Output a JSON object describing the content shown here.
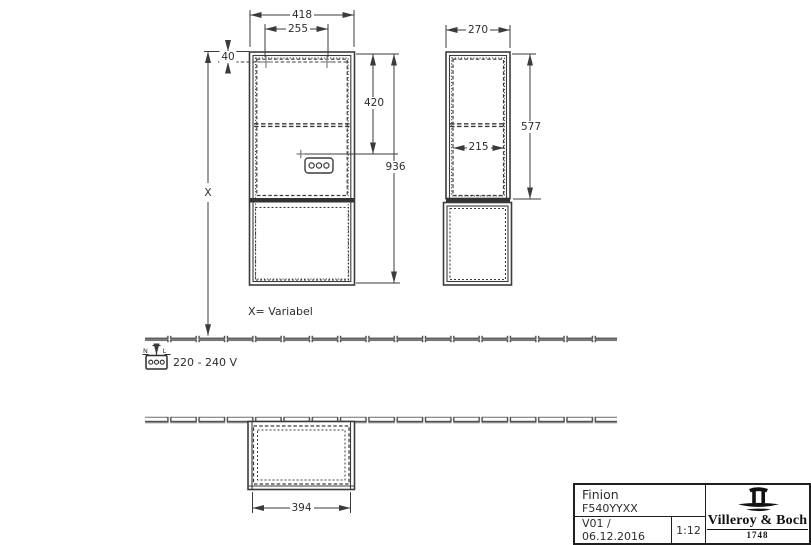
{
  "drawing": {
    "dimensions": {
      "overall_width": "418",
      "mounting_spacing": "255",
      "top_offset": "40",
      "socket_height": "420",
      "overall_height": "936",
      "variable_height": "X",
      "depth": "270",
      "upper_section_height": "577",
      "inner_depth": "215",
      "carcass_width": "394"
    },
    "notes": {
      "variable_note": "X= Variabel",
      "voltage": "220 - 240 V",
      "terminal_neutral": "N",
      "terminal_line": "L"
    }
  },
  "title_block": {
    "product": "Finion",
    "article_number": "F540YYXX",
    "version_date": "V01 / 06.12.2016",
    "scale": "1:12",
    "brand": "Villeroy & Boch",
    "brand_year": "1748"
  },
  "colors": {
    "line": "#3b3b3b",
    "heavy_fill": "#333333",
    "text": "#2d2d2d",
    "background": "#ffffff"
  }
}
